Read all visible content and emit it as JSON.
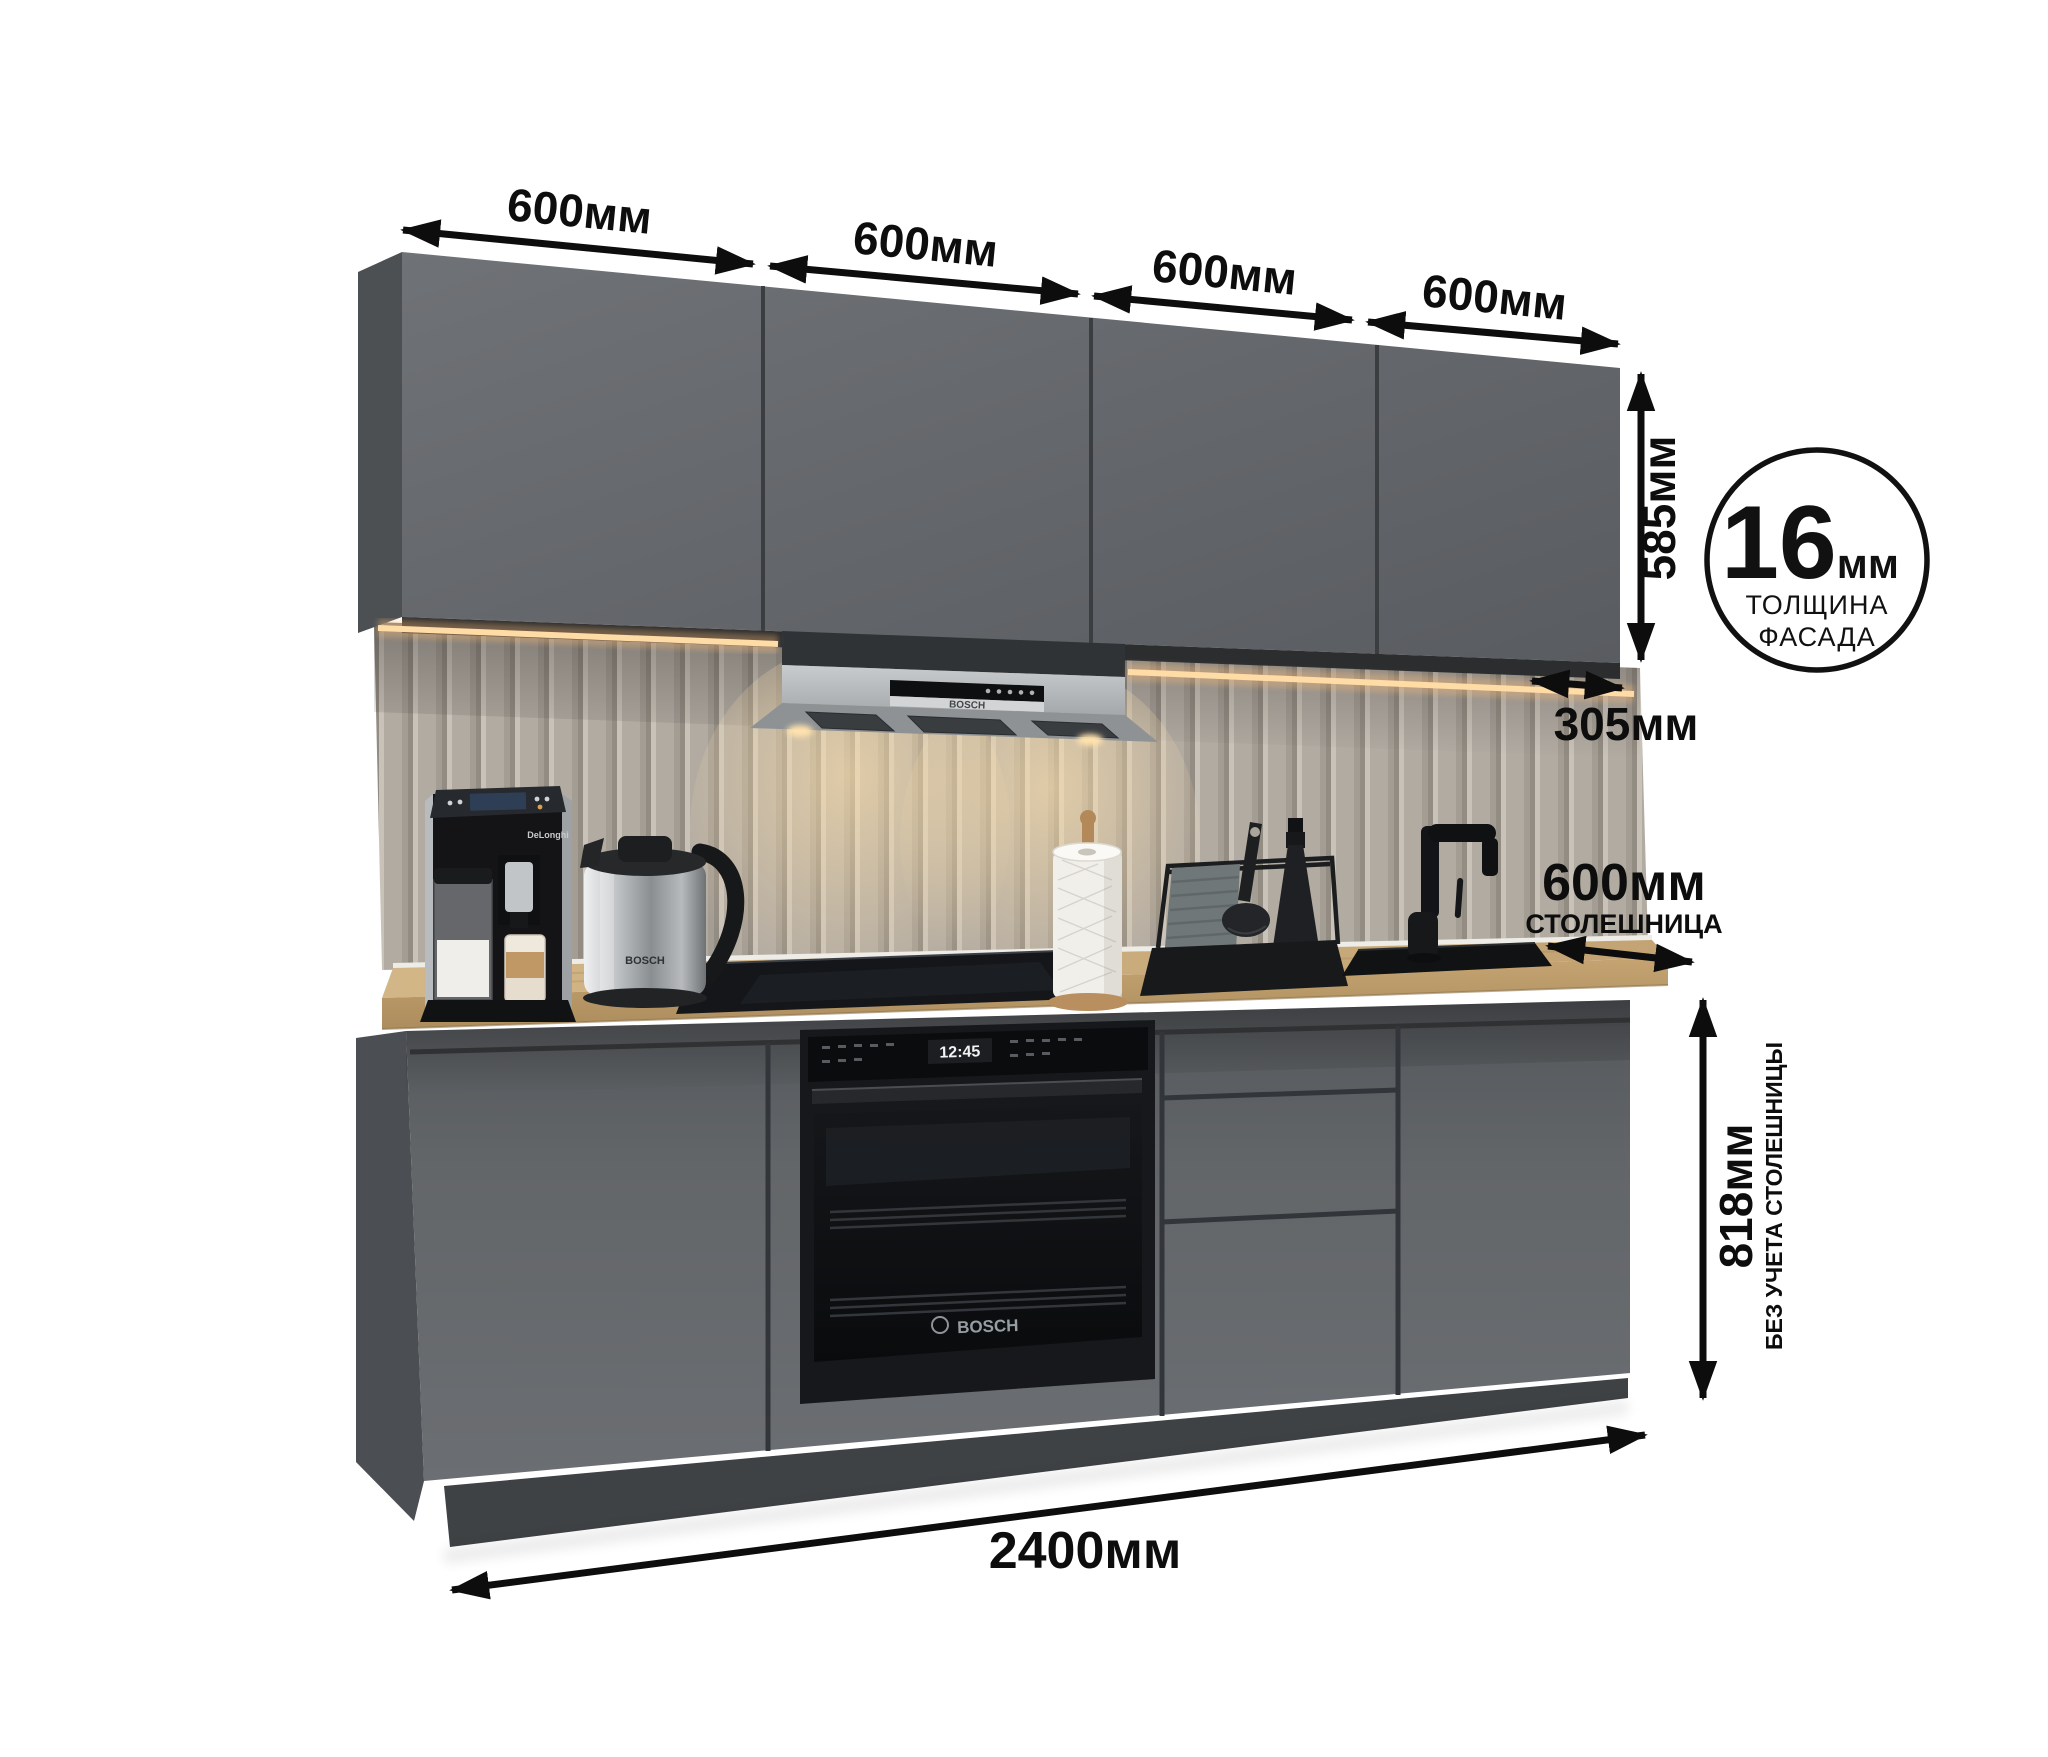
{
  "dimensions": {
    "top_widths": [
      "600мм",
      "600мм",
      "600мм",
      "600мм"
    ],
    "upper_cabinet_height": "585мм",
    "upper_cabinet_depth": "305мм",
    "worktop_depth_value": "600мм",
    "worktop_depth_caption": "СТОЛЕШНИЦА",
    "base_height_value": "818мм",
    "base_height_caption": "БЕЗ УЧЕТА СТОЛЕШНИЦЫ",
    "total_width": "2400мм"
  },
  "facade_badge": {
    "value": "16",
    "unit": "мм",
    "caption_line1": "ТОЛЩИНА",
    "caption_line2": "ФАСАДА"
  },
  "appliances": {
    "hood_brand": "BOSCH",
    "oven_brand": "BOSCH",
    "oven_display_time": "12:45",
    "kettle_brand": "BOSCH",
    "coffee_machine_brand": "DeLonghi"
  },
  "colors": {
    "cabinet_front": "#63666a",
    "worktop_wood": "#c8a97a",
    "backsplash": "#b2aba2",
    "led_light": "#ffd9a2",
    "annotation": "#0d0d0d"
  }
}
